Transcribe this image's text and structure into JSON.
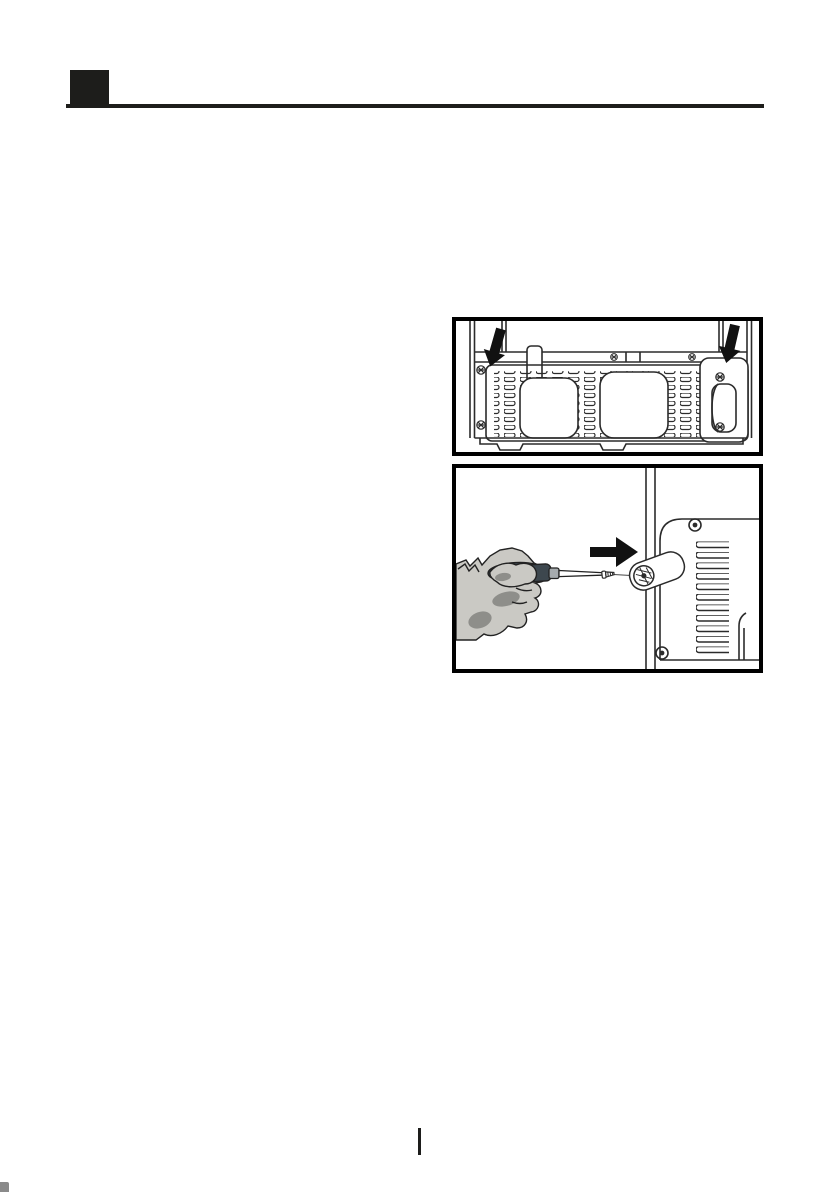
{
  "page": {
    "kind": "appliance-manual-page",
    "background_color": "#ffffff",
    "ink_color": "#1d1d1b"
  },
  "header": {
    "section_marker_icon": "filled-black-square",
    "marker_color": "#1d1d1b",
    "rule_color": "#1d1d1b"
  },
  "figures": [
    {
      "name": "rear-panel-screws",
      "description": "Line drawing of the lower rear panel of the appliance with ventilation slots, two rounded openings, a recessed handle and mounting screws; two solid black arrows point down toward the screws on the left and right flanges.",
      "border_color": "#000000",
      "line_color": "#2b2b2b",
      "arrow_color": "#111111",
      "icons": [
        "down-arrow-icon",
        "down-arrow-icon",
        "screw-icon",
        "vent-grille"
      ]
    },
    {
      "name": "side-screw-with-screwdriver",
      "description": "Line drawing of a hand holding a screwdriver driving a screw and a cover cap into the side edge of the appliance next to a vented side panel; a solid black arrow points right.",
      "border_color": "#000000",
      "line_color": "#2b2b2b",
      "arrow_color": "#111111",
      "hand_skin_color": "#cac9c4",
      "hand_shadow_color": "#8e8e8a",
      "screwdriver_handle_color": "#3d474e",
      "screwdriver_ferrule_color": "#a6abae",
      "icons": [
        "right-arrow-icon",
        "screwdriver-icon",
        "screw-icon",
        "screw-cover-cap",
        "vent-grille"
      ]
    }
  ],
  "footer": {
    "divider_glyph": "|",
    "divider_color": "#1d1d1b"
  },
  "print_artifact": {
    "color": "#2a2a2a"
  }
}
